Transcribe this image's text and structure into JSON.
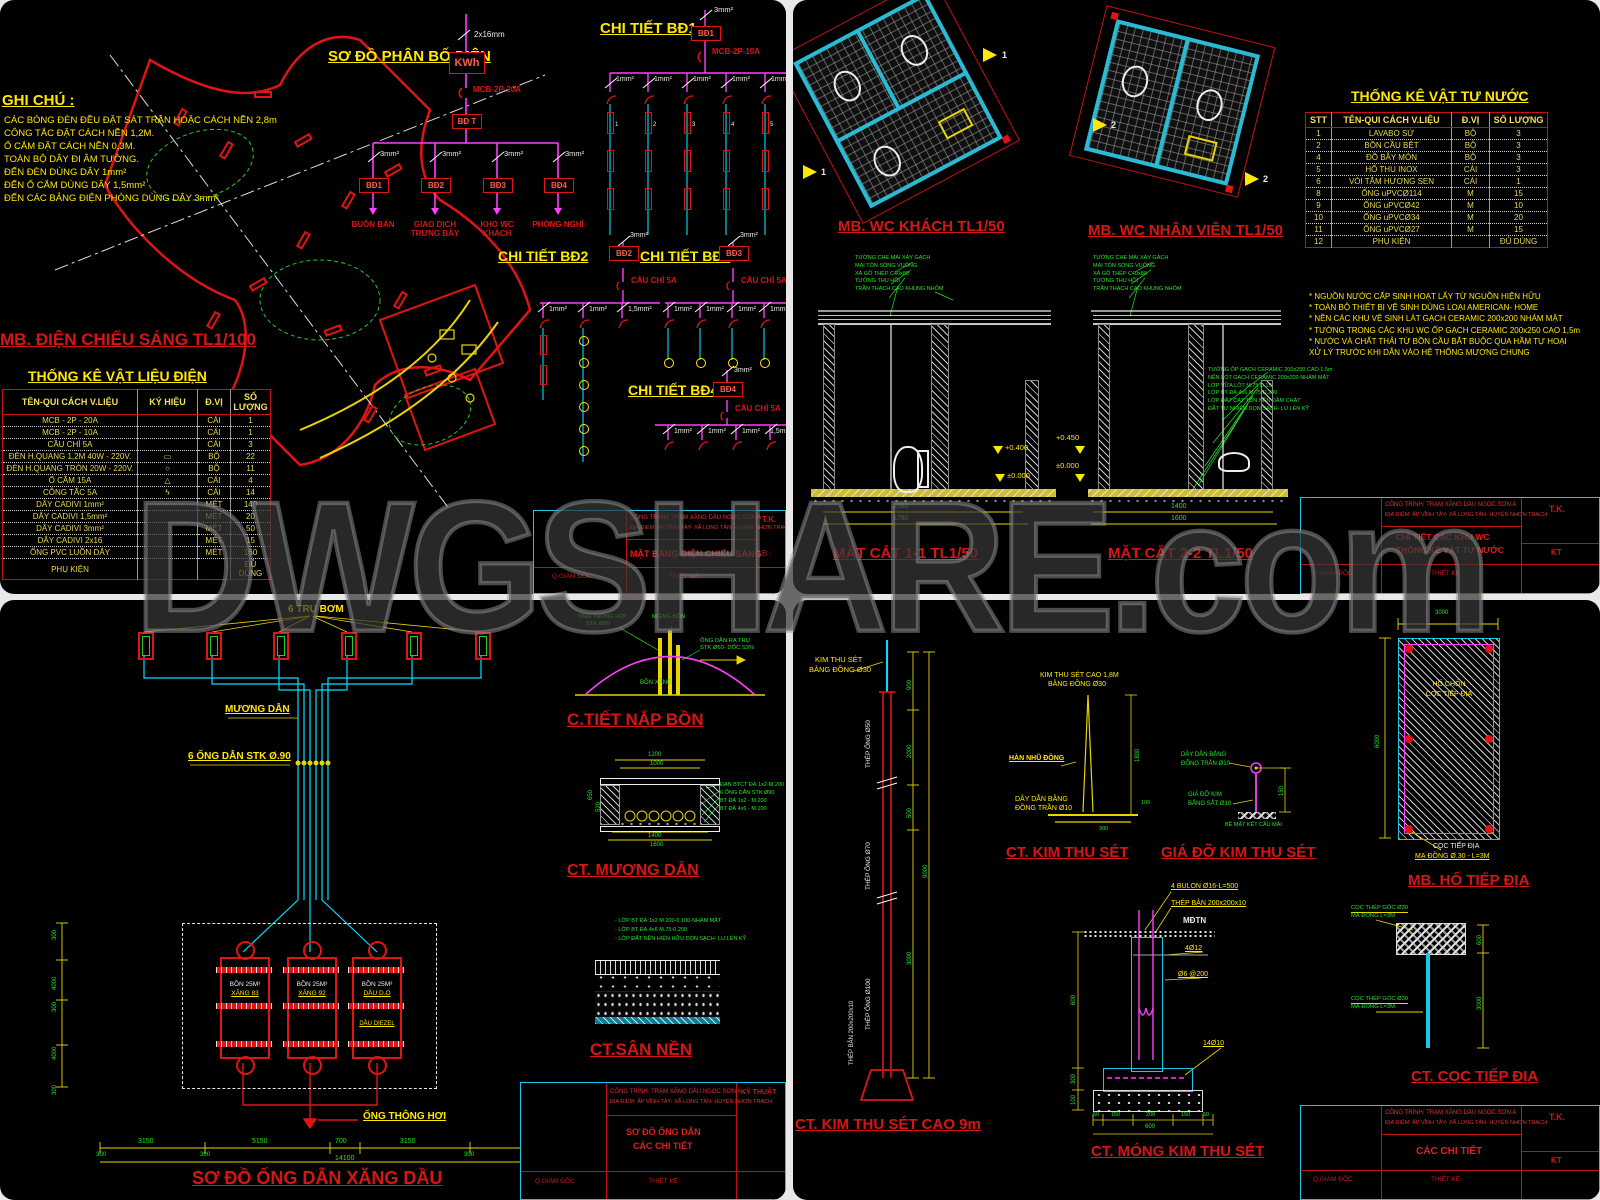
{
  "watermark": "DWGSHARE.com",
  "common": {
    "titleblock": {
      "project_line1": "CÔNG TRÌNH: TRẠM XĂNG DẦU NGỌC SƠN A",
      "project_line2": "ĐỊA ĐIỂM: ẤP VĨNH TÂY- XÃ LONG TÂN- HUYỆN NHƠN TRẠCH",
      "role_director": "Q.GIÁM ĐỐC",
      "role_design": "THIẾT KẾ",
      "tk": "T.K.",
      "kt": "KT"
    }
  },
  "q1": {
    "notes_title": "GHI CHÚ :",
    "notes": [
      "CÁC BÓNG ĐÈN ĐỀU ĐẶT SÁT TRẦN HOẶC CÁCH NỀN 2,8m",
      "CÔNG TẮC ĐẶT CÁCH NỀN 1,2M.",
      "Ổ CẮM ĐẶT CÁCH NỀN 0,3M.",
      "TOÀN BỘ DÂY ĐI ÂM TƯỜNG.",
      "ĐẾN ĐÈN DÙNG DÂY 1mm²",
      "ĐẾN Ổ CẮM DÙNG DÂY 1,5mm²",
      "ĐẾN CÁC BẢNG ĐIỆN PHÒNG DÙNG DÂY 3mm²"
    ],
    "dist": {
      "title": "SƠ ĐỒ PHÂN BỐ ĐIỆN",
      "feeder": "2x16mm",
      "meter": "KWh",
      "mcb": "MCB-2P-20A",
      "main_board": "BĐ T",
      "branch_wire": "3mm²",
      "boards": [
        "BĐ1",
        "BĐ2",
        "BĐ3",
        "BĐ4"
      ],
      "loads": [
        "BUÔN BÁN",
        "GIAO DỊCH TRƯNG BÀY",
        "KHO WC KHÁCH",
        "PHÒNG NGHỈ"
      ]
    },
    "bd1": {
      "title": "CHI TIẾT BĐ1",
      "board": "BĐ1",
      "feeder": "3mm²",
      "protection": "MCB-2P-10A",
      "wires": [
        "1mm²",
        "1mm²",
        "1mm²",
        "1mm²",
        "1mm²"
      ],
      "lamp_numbers": [
        "1",
        "2",
        "3",
        "4",
        "5"
      ]
    },
    "bd2": {
      "title": "CHI TIẾT BĐ2",
      "board": "BĐ2",
      "feeder": "3mm²",
      "protection": "CẦU CHÌ 5A",
      "wires": [
        "1mm²",
        "1mm²",
        "1,5mm²"
      ]
    },
    "bd3": {
      "title": "CHI TIẾT BĐ3",
      "board": "BĐ3",
      "feeder": "3mm²",
      "protection": "CẦU CHÌ 5A",
      "wires": [
        "1mm²",
        "1mm²",
        "1mm²",
        "1mm²"
      ]
    },
    "bd4": {
      "title": "CHI TIẾT BĐ4",
      "board": "BĐ4",
      "feeder": "3mm²",
      "protection": "CẦU CHÌ 5A",
      "wires": [
        "1mm²",
        "1mm²",
        "1mm²",
        "1,5mm²"
      ]
    },
    "plan_title": "MB. ĐIỆN CHIẾU SÁNG TL1/100",
    "table": {
      "title": "THỐNG KÊ VẬT LIỆU ĐIỆN",
      "headers": [
        "TÊN-QUI CÁCH V.LIỆU",
        "KÝ HIỆU",
        "Đ.VỊ",
        "SỐ LƯỢNG"
      ],
      "rows": [
        [
          "MCB - 2P - 20A",
          "",
          "CÁI",
          "1"
        ],
        [
          "MCB - 2P - 10A",
          "",
          "CÁI",
          "1"
        ],
        [
          "CẦU CHÌ 5A",
          "",
          "CÁI",
          "3"
        ],
        [
          "ĐÈN H.QUANG 1,2M 40W - 220V.",
          "▭",
          "BỘ",
          "22"
        ],
        [
          "ĐÈN H.QUANG TRÒN 20W - 220V.",
          "○",
          "BỘ",
          "11"
        ],
        [
          "Ổ CẮM 15A",
          "△",
          "CÁI",
          "4"
        ],
        [
          "CÔNG TẮC 5A",
          "ϟ",
          "CÁI",
          "14"
        ],
        [
          "DÂY CADIVI 1mm²",
          "",
          "MÉT",
          "140"
        ],
        [
          "DÂY CADIVI 1,5mm²",
          "",
          "MÉT",
          "20"
        ],
        [
          "DÂY CADIVI 3mm²",
          "",
          "MÉT",
          "50"
        ],
        [
          "DÂY CADIVI 2x16",
          "",
          "MÉT",
          "15"
        ],
        [
          "ỐNG PVC LUỒN DÂY",
          "",
          "MÉT",
          "160"
        ],
        [
          "PHỤ KIỆN",
          "",
          "",
          "ĐỦ DÙNG"
        ]
      ]
    },
    "drawing_name": "MẶT BẰNG ĐIỆN CHIẾU SÁNG",
    "tb_right": "B :"
  },
  "q2": {
    "plan1_title": "MB. WC KHÁCH TL1/50",
    "plan2_title": "MB. WC NHÂN VIÊN TL1/50",
    "flag1": "1",
    "flag2": "2",
    "table": {
      "title": "THỐNG KÊ VẬT TƯ NƯỚC",
      "headers": [
        "STT",
        "TÊN-QUI CÁCH V.LIỆU",
        "Đ.VỊ",
        "SỐ LƯỢNG"
      ],
      "rows": [
        [
          "1",
          "LAVABO SỨ",
          "BỘ",
          "3"
        ],
        [
          "2",
          "BỒN CẦU BỆT",
          "BỘ",
          "3"
        ],
        [
          "4",
          "ĐỒ BẪY MÓN",
          "BỘ",
          "3"
        ],
        [
          "5",
          "HỐ THU INOX",
          "CÁI",
          "3"
        ],
        [
          "6",
          "VÒI TẮM HƯƠNG SEN",
          "CÁI",
          "1"
        ],
        [
          "8",
          "ỐNG uPVCØ114",
          "M",
          "15"
        ],
        [
          "9",
          "ỐNG uPVCØ42",
          "M",
          "10"
        ],
        [
          "10",
          "ỐNG uPVCØ34",
          "M",
          "20"
        ],
        [
          "11",
          "ỐNG uPVCØ27",
          "M",
          "15"
        ],
        [
          "12",
          "PHỤ KIỆN",
          "",
          "ĐỦ DÙNG"
        ]
      ]
    },
    "notes": [
      "* NGUỒN NƯỚC CẤP SINH HOẠT LẤY TỪ NGUỒN HIỆN HỮU",
      "* TOÀN BỘ THIẾT BỊ VỆ SINH DÙNG LOẠI AMERICAN- HOME",
      "* NỀN CÁC KHU VỆ SINH LÁT GẠCH CERAMIC 200x200 NHÁM MẶT",
      "* TƯỜNG TRONG CÁC KHU WC ỐP GẠCH CERAMIC 200x250 CAO 1,5m",
      "* NƯỚC VÀ CHẤT THẢI TỪ BỒN CẦU BẮT BUỘC QUA HẦM TỰ HOẠI",
      "  XỬ LÝ TRƯỚC KHI DẪN VÀO HỆ THỐNG MƯƠNG CHUNG"
    ],
    "roof_notes": [
      "TƯỜNG CHE MÁI XÂY GẠCH",
      "MÁI TÔN SÓNG VUÔNG",
      "XÀ GỒ THÉP C40x80",
      "TƯỜNG THU HỒI",
      "TRẦN THẠCH CAO KHUNG NHÔM"
    ],
    "floor_notes": [
      "TƯỜNG ỐP GẠCH CERAMIC 200x250 CAO 1.5m",
      "NỀN LÓT GẠCH CERAMIC 200x200 NHÁM MẶT",
      "LỚP VỮA LÓT M.75 D.15",
      "LỚP BT ĐÁ 4x6 M.75 D.200",
      "LỚP ĐẤT CÁT TÔN NỀN ĐẦM CHẶT",
      "ĐẤT TỰ NHIÊN DỌN SẠCH- LU LÈN KỸ"
    ],
    "sec1": {
      "title": "MẶT CẮT 1-1 TL1/50",
      "dim1": "1580",
      "dim2": "1780",
      "elev1": "+0.400",
      "elev2": "±0.000"
    },
    "sec2": {
      "title": "MẶT CẮT 2-2 TL1/50",
      "dim1": "1400",
      "dim2": "1600",
      "elev1": "+0.450",
      "elev2": "±0.000"
    },
    "drawing_name1": "CHI TIẾT CÁC KHU WC",
    "drawing_name2": "THỐNG KÊ VẬT TƯ NƯỚC"
  },
  "q3": {
    "pumps_label": "6 TRỤ BƠM",
    "channel_label": "MƯƠNG DẪN",
    "pipes_label": "6 ỐNG DẪN STK Ø.90",
    "vent_label": "ỐNG THÔNG HƠI",
    "tanks": [
      {
        "line1": "BỒN 25M³",
        "line2": "XĂNG 83",
        "line3": ""
      },
      {
        "line1": "BỒN 25M³",
        "line2": "XĂNG 92",
        "line3": ""
      },
      {
        "line1": "BỒN 25M³",
        "line2": "DẦU D.O",
        "line3": "DẦU DIEZEL"
      }
    ],
    "dims_bottom": [
      "3150",
      "5150",
      "700",
      "3150",
      "3150"
    ],
    "dims_small": [
      "300",
      "300",
      "300",
      "300"
    ],
    "dim_total": "14100",
    "dims_left": [
      "300",
      "4000",
      "300",
      "4000",
      "300"
    ],
    "main_title": "SƠ ĐỒ ỐNG DẪN XĂNG DẦU",
    "cap": {
      "title": "C.TIẾT NẮP BỒN",
      "label1a": "ỐNG THÔNG HƠI",
      "label1b": "STK Ø50",
      "label2": "MIỆNG BỒN",
      "label3a": "ỐNG DẪN RA TRỤ",
      "label3b": "STK Ø60- DỐC S3%",
      "label4": "BỒN XĂNG"
    },
    "channel": {
      "title": "CT. MƯƠNG DẪN",
      "dim_top1": "1200",
      "dim_top2": "1000",
      "layers": [
        "ĐAN BTCT ĐÁ 1x2-M.200",
        "6 ỐNG DẪN STK Ø90",
        "BT ĐÁ 1x2 - M.200",
        "BT ĐÁ 4x6 - M.100"
      ],
      "dim_bot1": "1400",
      "dim_bot2": "1600",
      "dim_l1": "650",
      "dim_l2": "520"
    },
    "floor": {
      "title": "CT.SÂN NỀN",
      "layers": [
        "- LỚP BT ĐÁ 1x2 M.200-0.100-NHÁM MẶT",
        "- LỚP BT ĐÁ 4x6 M.75-0.200",
        "- LỚP ĐẤT NỀN HIỆN HỮU DỌN SẠCH- LU LÈN KỸ"
      ]
    },
    "drawing_name1": "SƠ ĐỒ ỐNG DẪN",
    "drawing_name2": "CÁC CHI TIẾT",
    "tb_right": "KỸ THUẬT"
  },
  "q4": {
    "pole": {
      "tip1": "KIM THU SÉT",
      "tip2": "BẰNG ĐỒNG Ø30",
      "seg1": "THÉP ỐNG Ø50",
      "seg2": "THÉP ỐNG Ø70",
      "seg3": "THÉP ỐNG Ø100",
      "base": "THÉP BẢN 200x200x10",
      "dims": [
        "900",
        "2000",
        "500",
        "3000"
      ],
      "dim_total": "9000",
      "title": "CT. KIM THU SÉT CAO 9m"
    },
    "kim": {
      "label1": "KIM THU SÉT CAO 1,8M",
      "label2": "BẰNG ĐỒNG Ø30",
      "weld": "HÀN NHŨ ĐỒNG",
      "wire1": "DÂY DẪN BẰNG",
      "wire2": "ĐỒNG TRẦN Ø10",
      "dim": "1800",
      "dim2": "100",
      "dim3": "200",
      "title": "CT. KIM THU SÉT"
    },
    "bracket": {
      "wire1": "DÂY DẪN BẰNG",
      "wire2": "ĐỒNG TRẦN Ø10",
      "rod1": "GIÁ ĐỠ KIM",
      "rod2": "BẰNG SẮT Ø10",
      "surface": "BỀ MẶT KẾT CẤU MÁI",
      "dim": "150",
      "title": "GIÁ ĐỠ KIM THU SÉT"
    },
    "pit": {
      "dim_w": "3000",
      "dim_h": "6000",
      "label1": "HỐ CHÔN",
      "label2": "CỌC TIẾP ĐỊA",
      "pile1": "CỌC TIẾP ĐỊA",
      "pile2": "MẠ ĐỒNG Ø.30 - L=3M",
      "title": "MB. HỐ TIẾP ĐỊA"
    },
    "found": {
      "bolts": "4 BULON Ø16-L=500",
      "plate": "THÉP BẢN 200x200x10",
      "ground": "MĐTN",
      "rebar": "4Ø12",
      "stirrup": "Ø6 @200",
      "mesh": "14Ø10",
      "dims_left": [
        "600",
        "300",
        "100"
      ],
      "dims_bottom": [
        "50",
        "150",
        "200",
        "150",
        "50"
      ],
      "dim_total": "600",
      "title": "CT. MÓNG KIM THU SÉT"
    },
    "pile": {
      "cap1": "CỌC THÉP GÓC Ø30",
      "cap2": "MẠ ĐỒNG L=3M",
      "dim1": "600",
      "dim2": "3000",
      "title": "CT. CỌC TIẾP ĐỊA"
    },
    "drawing_name": "CÁC CHI TIẾT"
  }
}
